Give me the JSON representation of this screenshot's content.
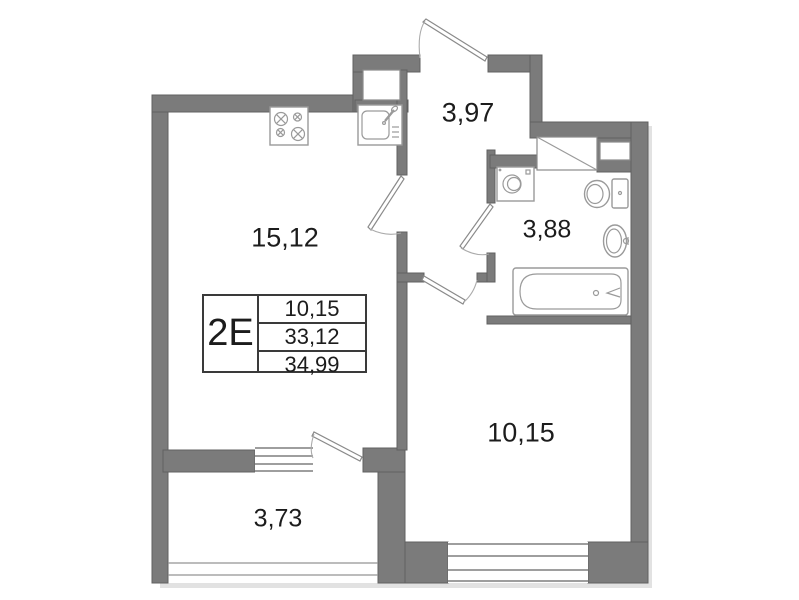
{
  "floor_plan": {
    "unit": {
      "label": "2Е",
      "area_rows": [
        "10,15",
        "33,12",
        "34,99"
      ]
    },
    "rooms": {
      "living_kitchen": "15,12",
      "hallway": "3,97",
      "bathroom": "3,88",
      "bedroom": "10,15",
      "balcony": "3,73"
    },
    "colors": {
      "wall": "#7b7b7b",
      "wall_stroke": "#606060",
      "fixture": "#9a9a9a",
      "window_line": "#7e7e7e",
      "text": "#1c1c1c"
    }
  }
}
